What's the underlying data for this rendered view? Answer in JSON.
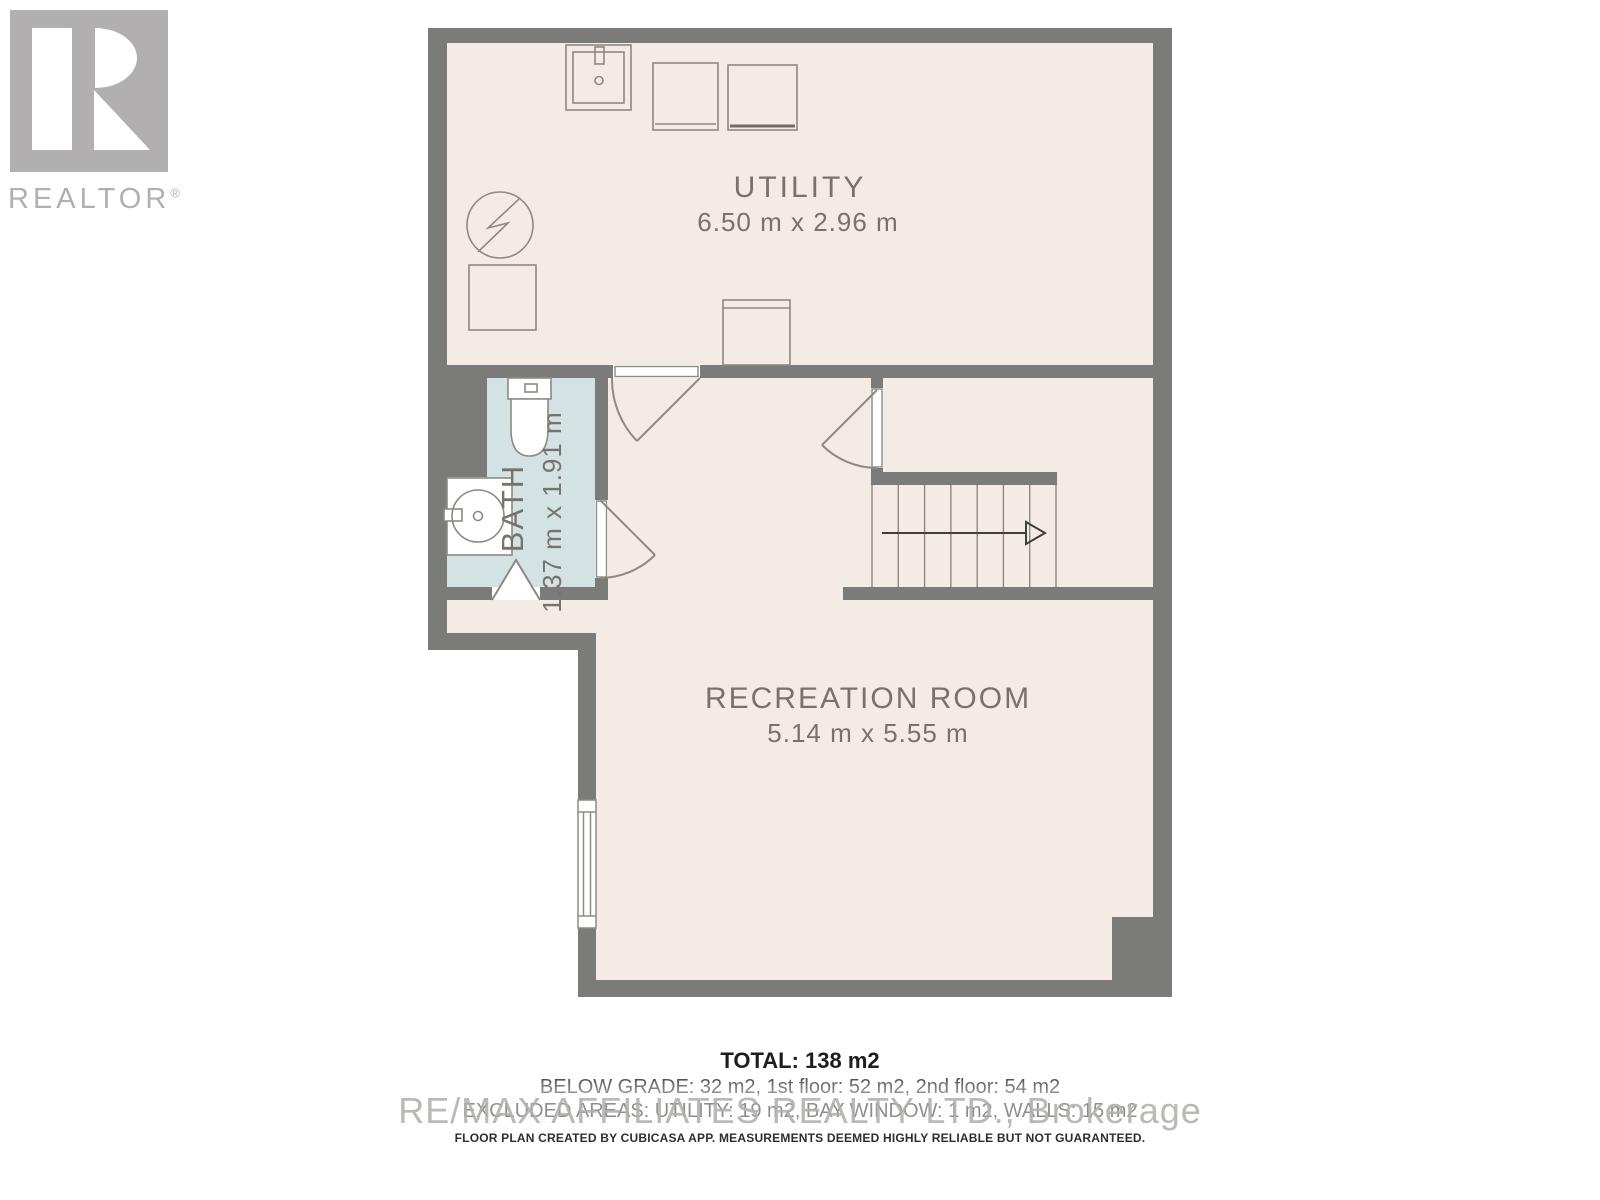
{
  "logo": {
    "brand": "REALTOR",
    "registered": "®"
  },
  "floor_plan": {
    "rooms": [
      {
        "name": "UTILITY",
        "dimensions": "6.50 m x 2.96 m"
      },
      {
        "name": "BATH",
        "dimensions": "1.37 m x 1.91 m"
      },
      {
        "name": "RECREATION ROOM",
        "dimensions": "5.14 m x 5.55 m"
      }
    ],
    "colors": {
      "wall": "#7b7b79",
      "floor": "#f4ebe5",
      "bath_floor": "#d3e2e3",
      "fixture_line": "#8d8983",
      "label_text": "#77736c",
      "stair_arrow": "#3f3f3f",
      "logo_gray": "#b1afaf"
    }
  },
  "summary": {
    "total": "TOTAL: 138 m2",
    "floors": "BELOW GRADE: 32 m2, 1st floor: 52 m2, 2nd floor: 54 m2",
    "excluded": "EXCLUDED AREAS: UTILITY: 19 m2, BAY WINDOW: 1 m2, WALLS: 15 m2"
  },
  "watermark": "RE/MAX AFFILIATES REALTY LTD., Brokerage",
  "disclaimer": "FLOOR PLAN CREATED BY CUBICASA APP. MEASUREMENTS DEEMED HIGHLY RELIABLE BUT NOT GUARANTEED."
}
